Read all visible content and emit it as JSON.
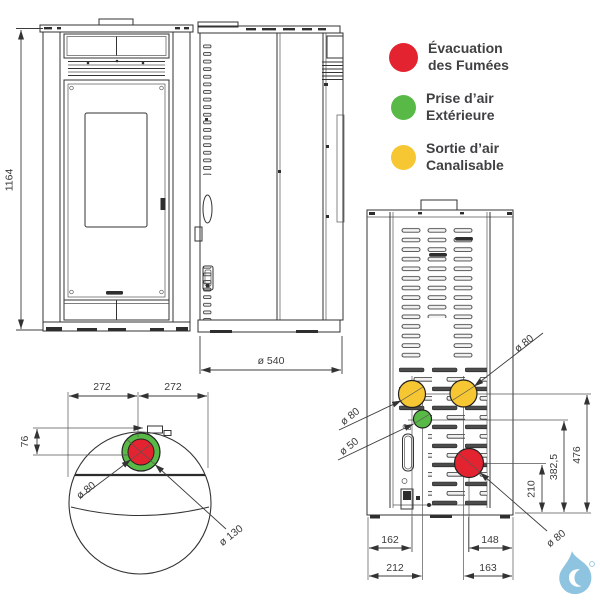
{
  "page": {
    "background": "#ffffff"
  },
  "colors": {
    "smoke_red": "#e42330",
    "air_green": "#59b947",
    "duct_yellow": "#f6c633",
    "drawing_line": "#333333",
    "dim_text": "#3b3b3b",
    "legend_text": "#414042",
    "watermark_blue": "#82bedd"
  },
  "legend": {
    "items": [
      {
        "color": "red",
        "label_line1": "Évacuation",
        "label_line2": "des Fumées"
      },
      {
        "color": "green",
        "label_line1": "Prise d’air",
        "label_line2": "Extérieure"
      },
      {
        "color": "yellow",
        "label_line1": "Sortie d’air",
        "label_line2": "Canalisable"
      }
    ]
  },
  "front_view": {
    "height_dim": "1164"
  },
  "side_view": {
    "depth_dim": "ø 540"
  },
  "top_view": {
    "width_left": "272",
    "width_right": "272",
    "offset_front": "76",
    "smoke_outlet_dia": "ø 80",
    "collar_dia": "ø 130"
  },
  "rear_view": {
    "duct_left_dia": "ø 80",
    "duct_right_dia": "ø 80",
    "intake_dia": "ø 50",
    "smoke_dia": "ø 80",
    "height_duct": "476",
    "height_intake": "382,5",
    "height_smoke": "210",
    "bottom_dim_left_1": "162",
    "bottom_dim_right_1": "148",
    "bottom_dim_left_2": "212",
    "bottom_dim_right_2": "163"
  }
}
